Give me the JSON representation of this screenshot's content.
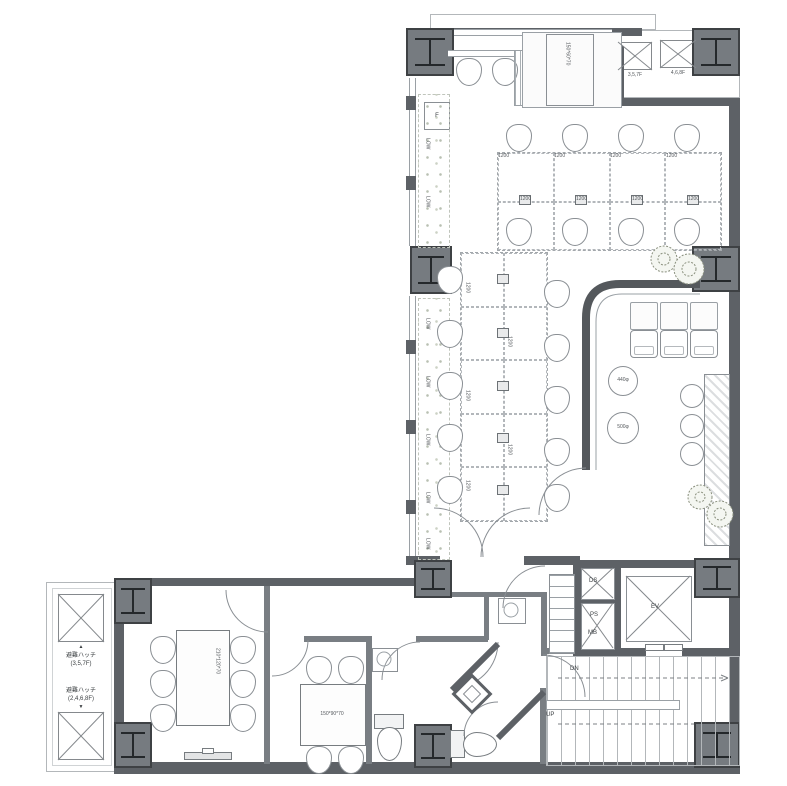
{
  "plan": {
    "type": "architectural-floor-plan-office",
    "colors": {
      "wall": "#5d6166",
      "column": "#767b80",
      "line": "#8a8f94",
      "plant": "#8a907e"
    },
    "labels": {
      "desk": "1200",
      "low": "LOW",
      "fridge": "F",
      "cabinet": "150*60*70",
      "table_large": "210*120*70",
      "table_small": "150*90*70",
      "round_table_small": "440φ",
      "round_table_large": "500φ",
      "ds": "DS",
      "ps": "PS",
      "mb": "MB",
      "ev": "EV",
      "dn": "DN",
      "up": "UP",
      "hatch_title": "避難ハッチ",
      "hatch_floors_a": "(3,5,7F)",
      "hatch_floors_b": "(2,4,6,8F)",
      "tr_hatch_a": "3,5,7F",
      "tr_hatch_b": "4,6,8F",
      "tri_up": "▲",
      "tri_dn": "▼"
    }
  }
}
